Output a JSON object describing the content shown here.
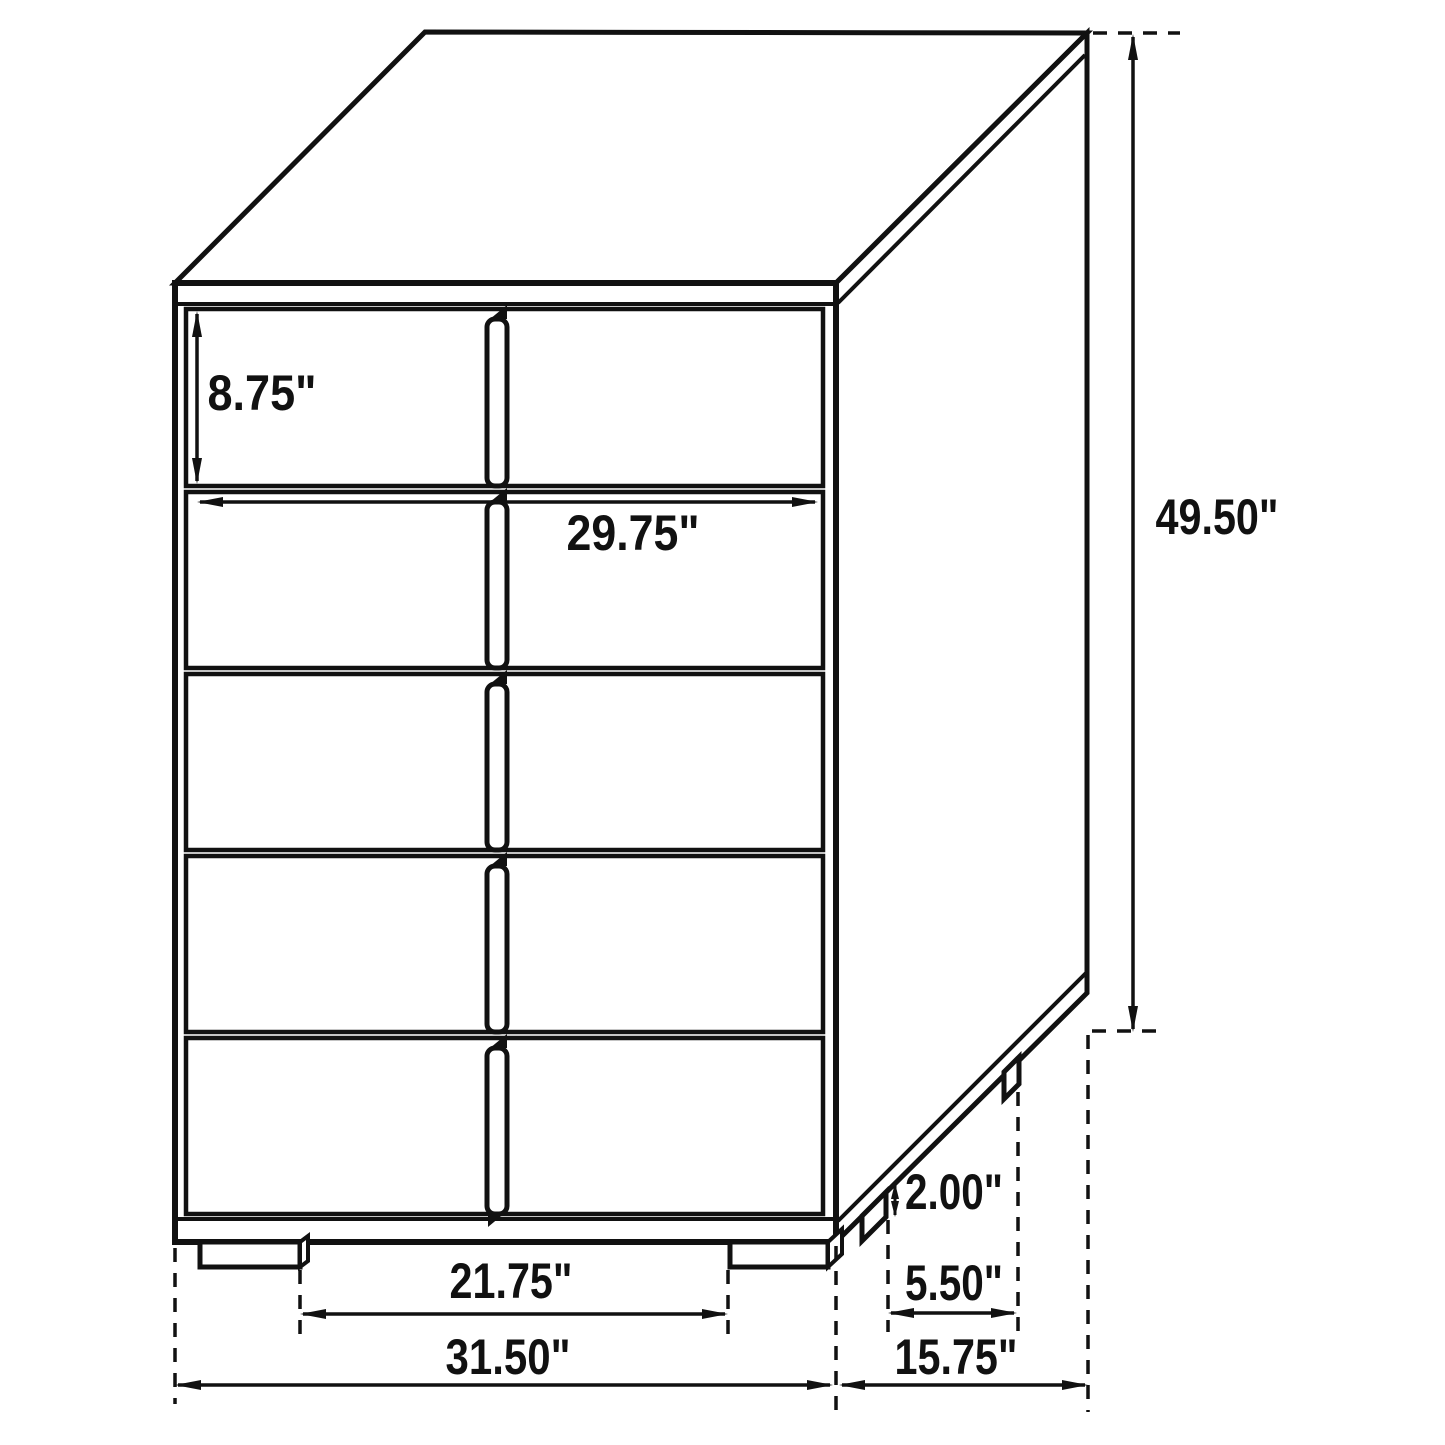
{
  "diagram": {
    "subject": "chest-of-drawers-dimension-diagram",
    "drawer_count": 5,
    "units": "inches",
    "ink_color": "#111111",
    "background_color": "#ffffff",
    "dimensions": {
      "drawer_height": {
        "label": "8.75\"",
        "value": 8.75
      },
      "drawer_width": {
        "label": "29.75\"",
        "value": 29.75
      },
      "overall_height": {
        "label": "49.50\"",
        "value": 49.5
      },
      "leg_height": {
        "label": "2.00\"",
        "value": 2.0
      },
      "side_leg_spacing": {
        "label": "5.50\"",
        "value": 5.5
      },
      "front_leg_spacing": {
        "label": "21.75\"",
        "value": 21.75
      },
      "overall_width": {
        "label": "31.50\"",
        "value": 31.5
      },
      "overall_depth": {
        "label": "15.75\"",
        "value": 15.75
      }
    }
  }
}
